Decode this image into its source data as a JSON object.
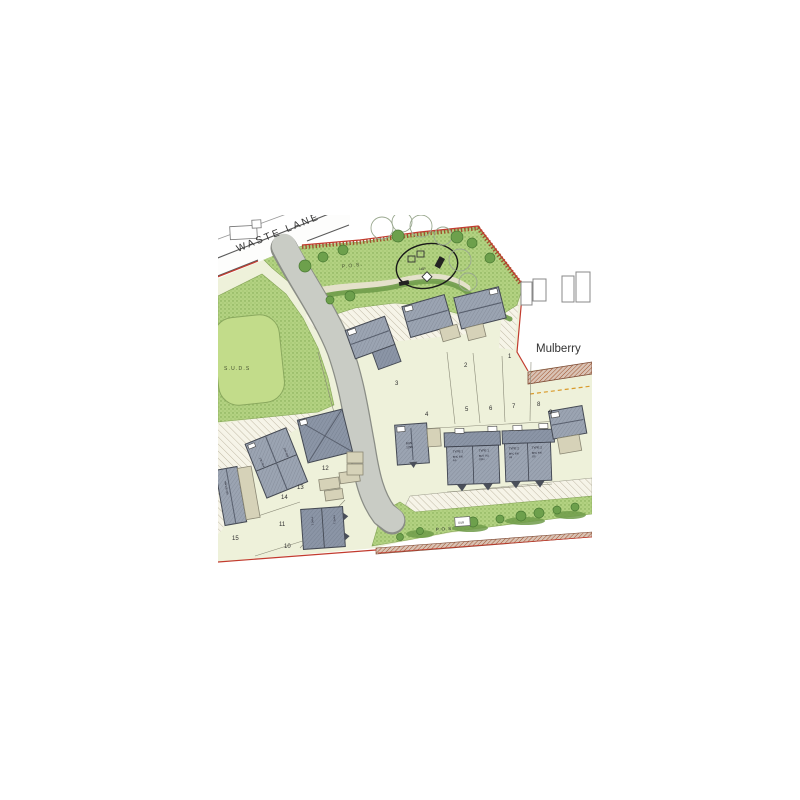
{
  "title": "Residential development site plan",
  "labels": {
    "road_name": "WASTE LANE",
    "street_name": "Mulberry",
    "pos_top": "P.O.S.",
    "pos_bottom": "P.O.S.",
    "suds": "S.U.D.S",
    "lap": "LAP",
    "sub": "SUB"
  },
  "plots": [
    {
      "number": "1"
    },
    {
      "number": "2"
    },
    {
      "number": "3"
    },
    {
      "number": "4"
    },
    {
      "number": "5"
    },
    {
      "number": "6"
    },
    {
      "number": "7"
    },
    {
      "number": "8"
    },
    {
      "number": "9"
    },
    {
      "number": "10"
    },
    {
      "number": "11"
    },
    {
      "number": "12"
    },
    {
      "number": "13"
    },
    {
      "number": "14"
    },
    {
      "number": "15"
    }
  ],
  "terrace_units": [
    {
      "type": "TYPE 1",
      "code": "BHC 930",
      "code2": "AS"
    },
    {
      "type": "TYPE 1",
      "code": "BUS 761",
      "code2": "OPH"
    },
    {
      "type": "TYPE 2",
      "code": "BHC 930",
      "code2": "U3"
    },
    {
      "type": "TYPE 2",
      "code": "BHC 930",
      "code2": "OS"
    }
  ],
  "house_codes": {
    "bun1": "BUN",
    "bun2": "1296",
    "semi13": "1-BJ 934",
    "semi14": "2HV 939",
    "semi_type": "TYPE 1",
    "plot15": "HW 005 268"
  },
  "colors": {
    "boundary_red": "#c23b2e",
    "wall_brick": "#a0522d",
    "dashed_orange": "#d99a2b",
    "road_gray": "#c9ccc5",
    "pos_green": "#b3d282",
    "pond_green": "#c2dc8a",
    "roof_gray": "#9ba4b2",
    "plot_bg": "#eef1da"
  }
}
